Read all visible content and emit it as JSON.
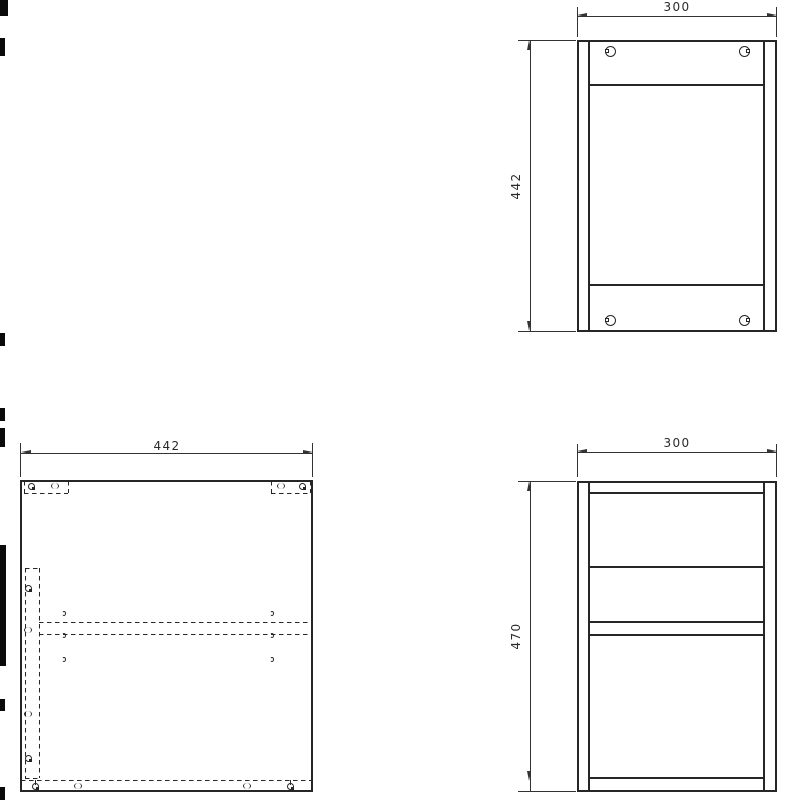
{
  "views": {
    "top_right": {
      "width_label": "300",
      "height_label": "442"
    },
    "bottom_right": {
      "width_label": "300",
      "height_label": "470"
    },
    "bottom_left": {
      "width_label": "442"
    }
  },
  "colors": {
    "line": "#262626",
    "dimension": "#333333",
    "background": "#ffffff",
    "text": "#2b2b2b"
  },
  "symbols": {
    "cam_lock": "cam-lock-icon",
    "dowel_hole": "dowel-hole-icon",
    "pilot_hole": "pilot-hole-icon"
  }
}
